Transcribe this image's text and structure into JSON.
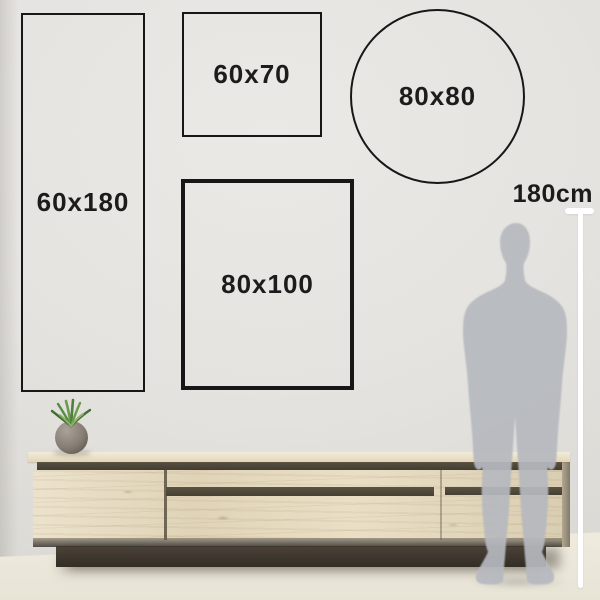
{
  "frames": [
    {
      "label": "60x180",
      "shape": "rectangle"
    },
    {
      "label": "60x70",
      "shape": "rectangle"
    },
    {
      "label": "80x80",
      "shape": "circle"
    },
    {
      "label": "80x100",
      "shape": "rectangle"
    }
  ],
  "measure": {
    "label": "180cm"
  },
  "scene": {
    "person": "human-silhouette",
    "furniture": "wooden-sideboard",
    "plant": "potted-plant"
  },
  "colors": {
    "frame_border": "#171717",
    "label_text": "#1c1c1c",
    "measure_line": "#ffffff",
    "wall": "#e5e3df",
    "floor": "#eae6da",
    "wood": "#e7dabd",
    "wood_groove": "#4c463d",
    "plinth": "#443c32",
    "person": "#b6b9bf"
  }
}
